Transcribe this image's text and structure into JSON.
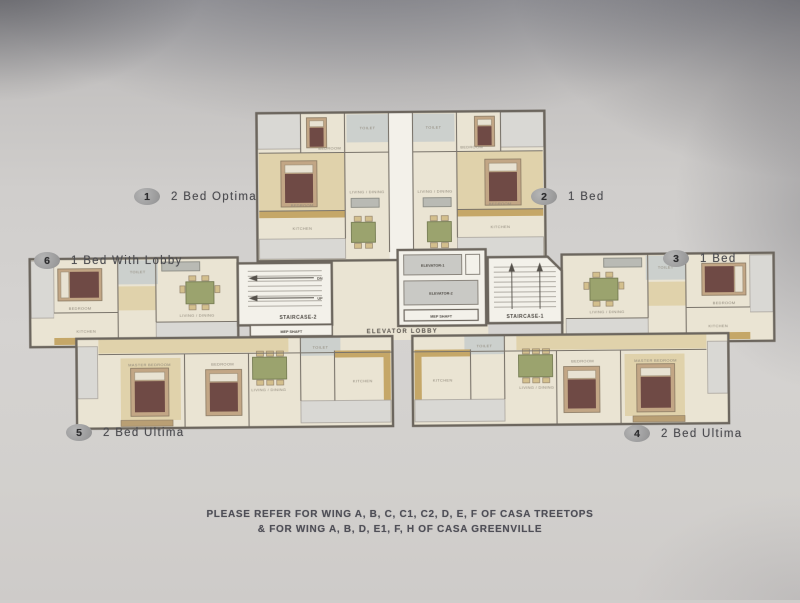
{
  "legend": {
    "items": [
      {
        "num": "1",
        "label": "2 Bed Optima"
      },
      {
        "num": "2",
        "label": "1 Bed"
      },
      {
        "num": "3",
        "label": "1 Bed"
      },
      {
        "num": "4",
        "label": "2 Bed Ultima"
      },
      {
        "num": "5",
        "label": "2 Bed Ultima"
      },
      {
        "num": "6",
        "label": "1 Bed With Lobby"
      }
    ]
  },
  "plan": {
    "core": {
      "elevator1": "ELEVATOR-1",
      "elevator2": "ELEVATOR-2",
      "mep_shaft": "MEP SHAFT",
      "staircase1": "STAIRCASE-1",
      "staircase2": "STAIRCASE-2",
      "elevator_lobby": "ELEVATOR LOBBY",
      "up": "UP",
      "dn": "DN"
    },
    "rooms": {
      "kitchen": "KITCHEN",
      "bedroom": "BEDROOM",
      "master_bedroom": "MASTER BEDROOM",
      "living_dining": "LIVING / DINING",
      "toilet": "TOILET"
    }
  },
  "footer": {
    "line1": "PLEASE REFER FOR WING A, B, C, C1, C2, D, E, F OF CASA TREETOPS",
    "line2": "& FOR WING A, B, D, E1, F, H OF CASA GREENVILLE"
  },
  "colors": {
    "paper": "#d2d0ce",
    "wall": "#6c665e",
    "floor_cream": "#eae4d3",
    "floor_tan": "#e0d2ab",
    "counter_khaki": "#c5a768",
    "bath_gray": "#ccd0cd",
    "bed_maroon": "#6f4a45"
  }
}
